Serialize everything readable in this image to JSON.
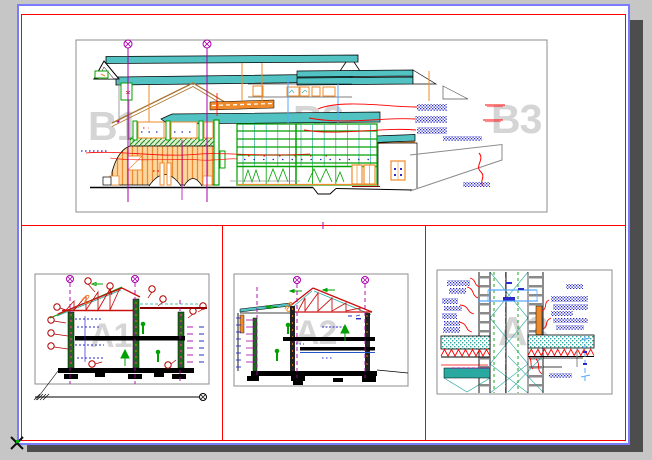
{
  "sheet": {
    "description": "CAD paper-space layout with four drawing viewports (building elevation, two cross sections, wall construction detail)",
    "app_background": "#c6c6c6",
    "paper_color": "#ffffff"
  },
  "watermarks": {
    "elevation_left": "B1",
    "elevation_middle": "B2",
    "elevation_right": "B3",
    "section_left": "A1",
    "section_middle": "A2",
    "detail_right": "A3"
  },
  "colors": {
    "app_background": "#c6c6c6",
    "paper": "#ffffff",
    "sheet_border_outer": "#7b7bff",
    "sheet_border_inner": "#ff0000",
    "viewport_divider": "#ff0000",
    "panel_border": "#8c8c8c",
    "watermark": "#d5d5d5",
    "roof_teal": "#53c2c2",
    "cad_green": "#00a000",
    "cad_orange": "#ef8a2a",
    "wall_fill_light_orange": "#fcd7a0",
    "grid_magenta": "#aa00aa",
    "leader_red": "#ff0000",
    "callout_dark_red": "#b40000",
    "truss_red": "#cc1111",
    "beam_dark_red": "#8b0000",
    "annotation_blue": "#2a2ac8",
    "light_blue": "#55aaff",
    "gable_brown": "#a9742e",
    "ladder_gray": "#8a8a8a",
    "ground_black": "#000000",
    "shadow": "#4d4d4d"
  }
}
